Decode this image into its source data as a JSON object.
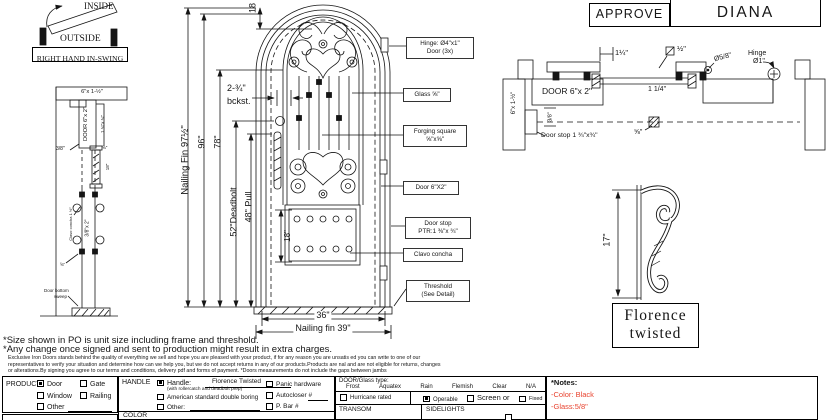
{
  "swing": {
    "inside": "INSIDE",
    "outside": "OUTSIDE",
    "caption": "RIGHT HAND IN-SWING"
  },
  "title_block": {
    "approve": "APPROVE",
    "name": "DIANA"
  },
  "jamb_section": {
    "header": "6\"x 1-½\"",
    "gap": "3/8\"",
    "door": "DOOR 6\"x 2\"",
    "stop": "1 ¾\"x ¾\"",
    "glass": "⅝\"",
    "height18": "18\"",
    "leaf": "3/8\"x 2\"",
    "clavo": "Clavo concha 1 ½\"",
    "dim58": "⅝\"",
    "sweep_line1": "Door bottom",
    "sweep_line2": "sweep"
  },
  "elevation": {
    "fin_height": "Nailing Fin 97½\"",
    "height96": "96\"",
    "height78": "78\"",
    "deadbolt": "52\"Deadbolt",
    "pull": "48\" Pull",
    "top18": "18",
    "backset_line1": "2-¾\"",
    "backset_line2": "bckst.",
    "panel18": "18\"",
    "width36": "36\"",
    "fin_width": "Nailing fin 39\"",
    "callouts": [
      {
        "line1": "Hinge: Ø4\"x1\"",
        "line2": "Door (3x)"
      },
      {
        "line1": "Glass ⅝\"",
        "line2": ""
      },
      {
        "line1": "Forging square",
        "line2": "⅝\"x⅝\""
      },
      {
        "line1": "Door  6\"X2\"",
        "line2": ""
      },
      {
        "line1": "Door stop",
        "line2": "PTR:1 ⅜\"x ¾\""
      },
      {
        "line1": "Clavo concha",
        "line2": ""
      },
      {
        "line1": "Threshold",
        "line2": "(See Detail)"
      }
    ]
  },
  "head_section": {
    "dim114": "1¼\"",
    "dim_half": "½\"",
    "dim58": "Ø5/8\"",
    "hinge_line1": "Hinge",
    "hinge_line2": "Ø1\"",
    "jamb": "6\"x 1-½\"",
    "door": "DOOR 6\"x 2\"",
    "dim114b": "1 1/4\"",
    "dim38": "3/8\"",
    "frac58": "⅝\"",
    "doorstop": "Door stop 1 ¾\"x¾\""
  },
  "scroll_detail": {
    "dim17": "17\"",
    "name_line1": "Florence",
    "name_line2": "twisted"
  },
  "footer": {
    "note1": "*Size shown in PO is unit size including frame and threshold.",
    "note2": "*Any change once signed and sent to production might result in extra charges.",
    "fine1": "Exclusive Iron Doors stands behind the quality of everything we sell and hope you are pleased with your product, if for any reason you are unsatis ed you can write to one of our",
    "fine2": "representatives to verify your situation and determine how can we help you, but we do not accept returns in any of our products.Products are  nal and are not eligible for returns, changes",
    "fine3": "or alterations.By signing you agree to our terms and conditions, delivery pdf and forms of payment. *Doors measurements do not include the gaps between jambs"
  },
  "form": {
    "product": {
      "label": "PRODUCT:",
      "options": [
        {
          "label": "Door",
          "checked": true
        },
        {
          "label": "Gate",
          "checked": false
        },
        {
          "label": "Window",
          "checked": false
        },
        {
          "label": "Railing",
          "checked": false
        },
        {
          "label": "Other",
          "checked": false
        }
      ]
    },
    "handle": {
      "label": "HANDLE",
      "handle_label": "Handle:",
      "handle_checked": true,
      "value": "Florence Twisted",
      "sub": "(with rollercatch and deadbolt prep)",
      "boring": "American standard double boring",
      "boring_checked": false,
      "other": "Other:",
      "other_checked": false,
      "panic": "Panic hardware",
      "panic_checked": false,
      "autocloser": "Autocloser #",
      "autocloser_checked": false,
      "pbar": "P. Bar #",
      "pbar_checked": false,
      "color_label": "COLOR"
    },
    "glass": {
      "label": "DOOR/Glass type:",
      "types": [
        "Frost",
        "Aquatex",
        "Rain",
        "Flemish",
        "Clear",
        "N/A"
      ],
      "hurricane": "Hurricane rated",
      "hurricane_checked": false,
      "operable": "Operable",
      "operable_checked": true,
      "screen": "Screen or",
      "screen_checked": false,
      "fixed": "Fixed",
      "fixed_checked": false,
      "transom": "TRANSOM",
      "sidelights": "SIDELIGHTS"
    },
    "notes": {
      "title": "*Notes:",
      "color_note": "-Color: Black",
      "glass_note": "-Glass:5/8\"",
      "accent": "#e8432f"
    }
  }
}
